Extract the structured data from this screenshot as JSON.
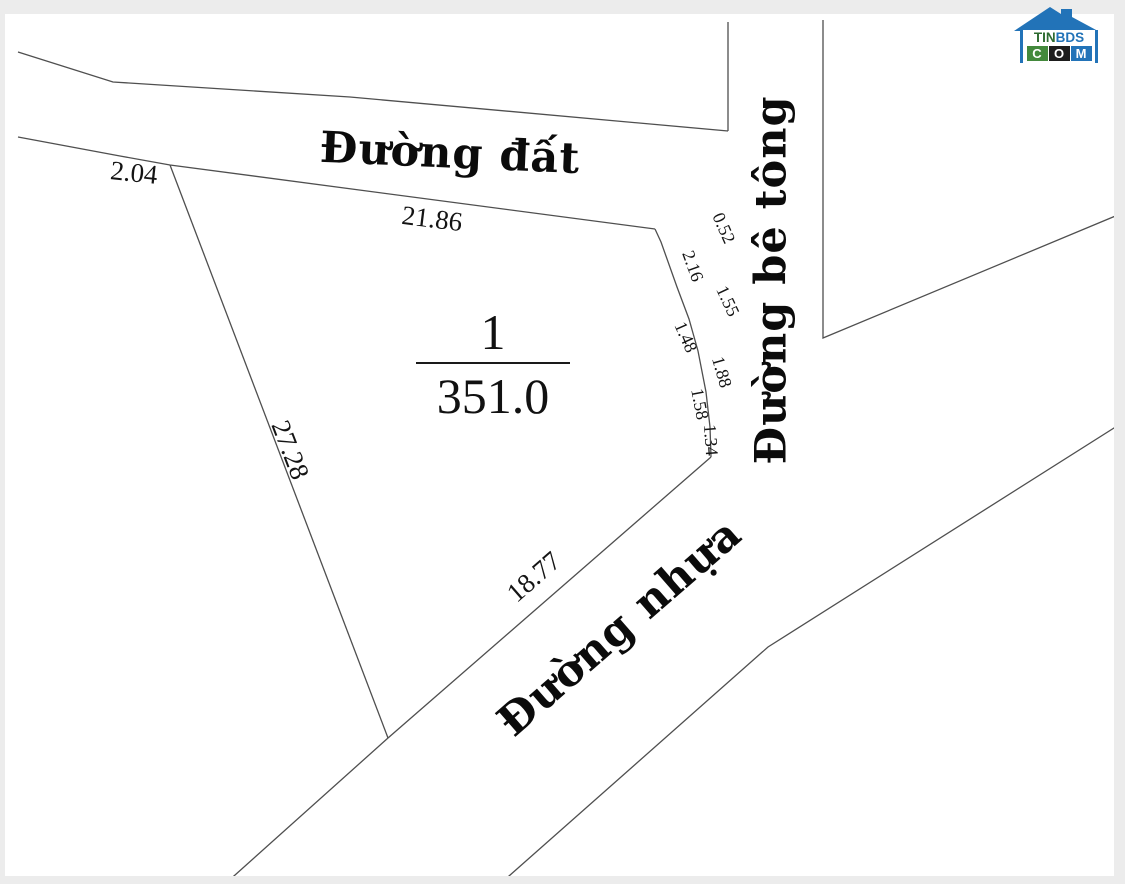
{
  "parcel": {
    "number": "1",
    "area": "351.0"
  },
  "roads": {
    "dirt": {
      "name": "Đường đất"
    },
    "concrete": {
      "name": "Đường bê tông"
    },
    "asphalt": {
      "name": "Đường nhựa"
    }
  },
  "measurements": {
    "top_left": "2.04",
    "top": "21.86",
    "left": "27.28",
    "bottom": "18.77",
    "right_segments": [
      "0.52",
      "2.16",
      "1.55",
      "1.48",
      "1.88",
      "1.58",
      "1.34"
    ]
  },
  "logo": {
    "line1_green": "TIN",
    "line1_blue": "BDS",
    "boxes": [
      {
        "letter": "C",
        "bg": "#43893c"
      },
      {
        "letter": "O",
        "bg": "#1d1d1d"
      },
      {
        "letter": "M",
        "bg": "#2273b8"
      }
    ],
    "roof_color": "#2273b8"
  },
  "colors": {
    "line": "#4f4f4f",
    "background": "#ffffff",
    "page_edge": "#ececec"
  },
  "map_lines": [
    {
      "name": "dirt-road-upper-edge",
      "points": "18,52 113,82 350,97 728,131"
    },
    {
      "name": "concrete-road-left-edge",
      "points": "728,22 728,131"
    },
    {
      "name": "dirt-road-lower-edge",
      "points": "18,137 120,156 170,165 655,229"
    },
    {
      "name": "parcel-right-boundary",
      "points": "655,229 661,242 677,287 689,319 698,351 706,392 710,427 711,457"
    },
    {
      "name": "parcel-left-boundary",
      "points": "170,165 388,738"
    },
    {
      "name": "asphalt-road-upper-edge",
      "points": "225,884 388,738 711,457"
    },
    {
      "name": "asphalt-road-lower-edge",
      "points": "500,884 768,647 1125,421"
    },
    {
      "name": "concrete-road-right-edge",
      "points": "823,20 823,338 1125,212"
    }
  ]
}
